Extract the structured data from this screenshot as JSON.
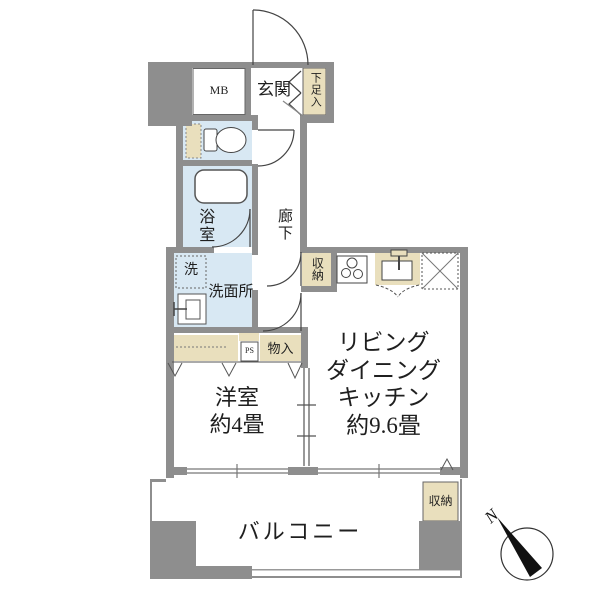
{
  "floorplan": {
    "labels": {
      "mb": "MB",
      "entrance": "玄関",
      "shoe_cabinet": "下足入",
      "bathroom": "浴室",
      "laundry": "洗",
      "washroom": "洗面所",
      "hallway": "廊下",
      "hallway_storage": "収納",
      "pipe_space": "PS",
      "closet": "物入",
      "western_room_name": "洋室",
      "western_room_size": "約4畳",
      "ldk_line1": "リビング",
      "ldk_line2": "ダイニング",
      "ldk_line3": "キッチン",
      "ldk_size": "約9.6畳",
      "balcony": "バルコニー",
      "balcony_storage": "収納",
      "compass_north": "N"
    },
    "colors": {
      "wall": "#8e8e8e",
      "wet_area": "#d8e8f3",
      "storage_fill": "#e9dfbd",
      "fixture_line": "#444444",
      "background": "#ffffff"
    }
  }
}
